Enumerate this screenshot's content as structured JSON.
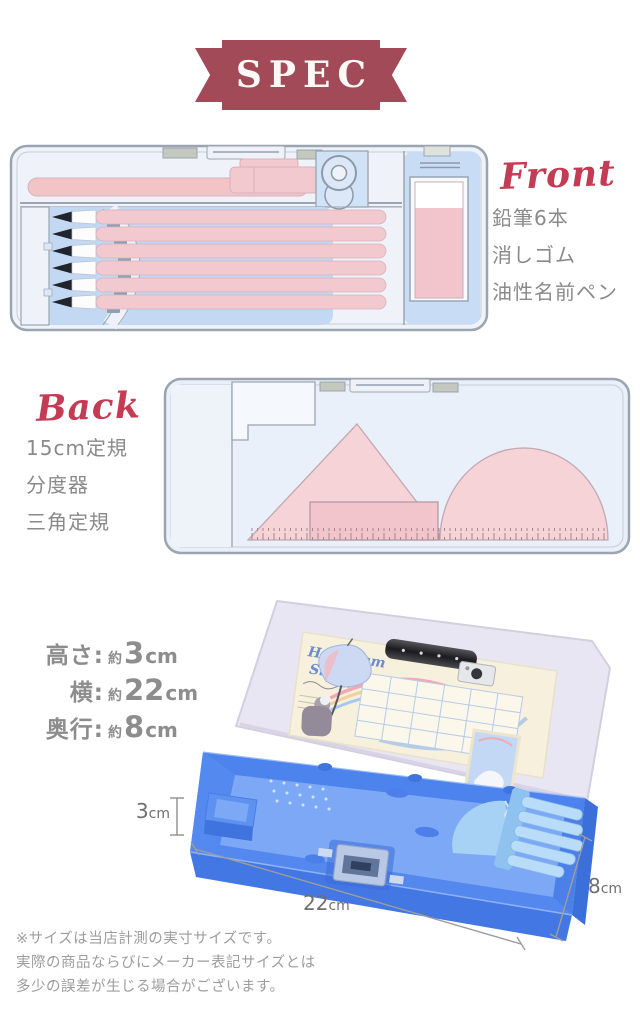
{
  "banner": {
    "label": "SPEC"
  },
  "front": {
    "label": "Front",
    "items": [
      "鉛筆6本",
      "消しゴム",
      "油性名前ペン"
    ]
  },
  "back": {
    "label": "Back",
    "items": [
      "15cm定規",
      "分度器",
      "三角定規"
    ]
  },
  "size_spec": {
    "rows": [
      {
        "label": "高さ:",
        "approx": "約",
        "value": "3",
        "unit": "cm"
      },
      {
        "label": "横:",
        "approx": "約",
        "value": "22",
        "unit": "cm"
      },
      {
        "label": "奥行:",
        "approx": "約",
        "value": "8",
        "unit": "cm"
      }
    ]
  },
  "measurements": {
    "height": {
      "value": "3",
      "unit": "cm"
    },
    "width": {
      "value": "22",
      "unit": "cm"
    },
    "depth": {
      "value": "8",
      "unit": "cm"
    }
  },
  "photo": {
    "card_title_line1": "Hologram",
    "card_title_line2": "Sky"
  },
  "footnote": {
    "lines": [
      "※サイズは当店計測の実寸サイズです。",
      "実際の商品ならびにメーカー表記サイズとは",
      "多少の誤差が生じる場合がございます。"
    ]
  },
  "colors": {
    "ribbon": "#a34a58",
    "script_red": "#c43b54",
    "illustration_outline": "#9aa5b1",
    "illustration_pink": "#f2c9ce",
    "illustration_blue": "#c3d9f3",
    "case_blue": "#5b8ff0",
    "lid_lavender": "#e9e6f3",
    "text_gray": "#8a8a8a",
    "footnote_gray": "#9d9d9d"
  }
}
